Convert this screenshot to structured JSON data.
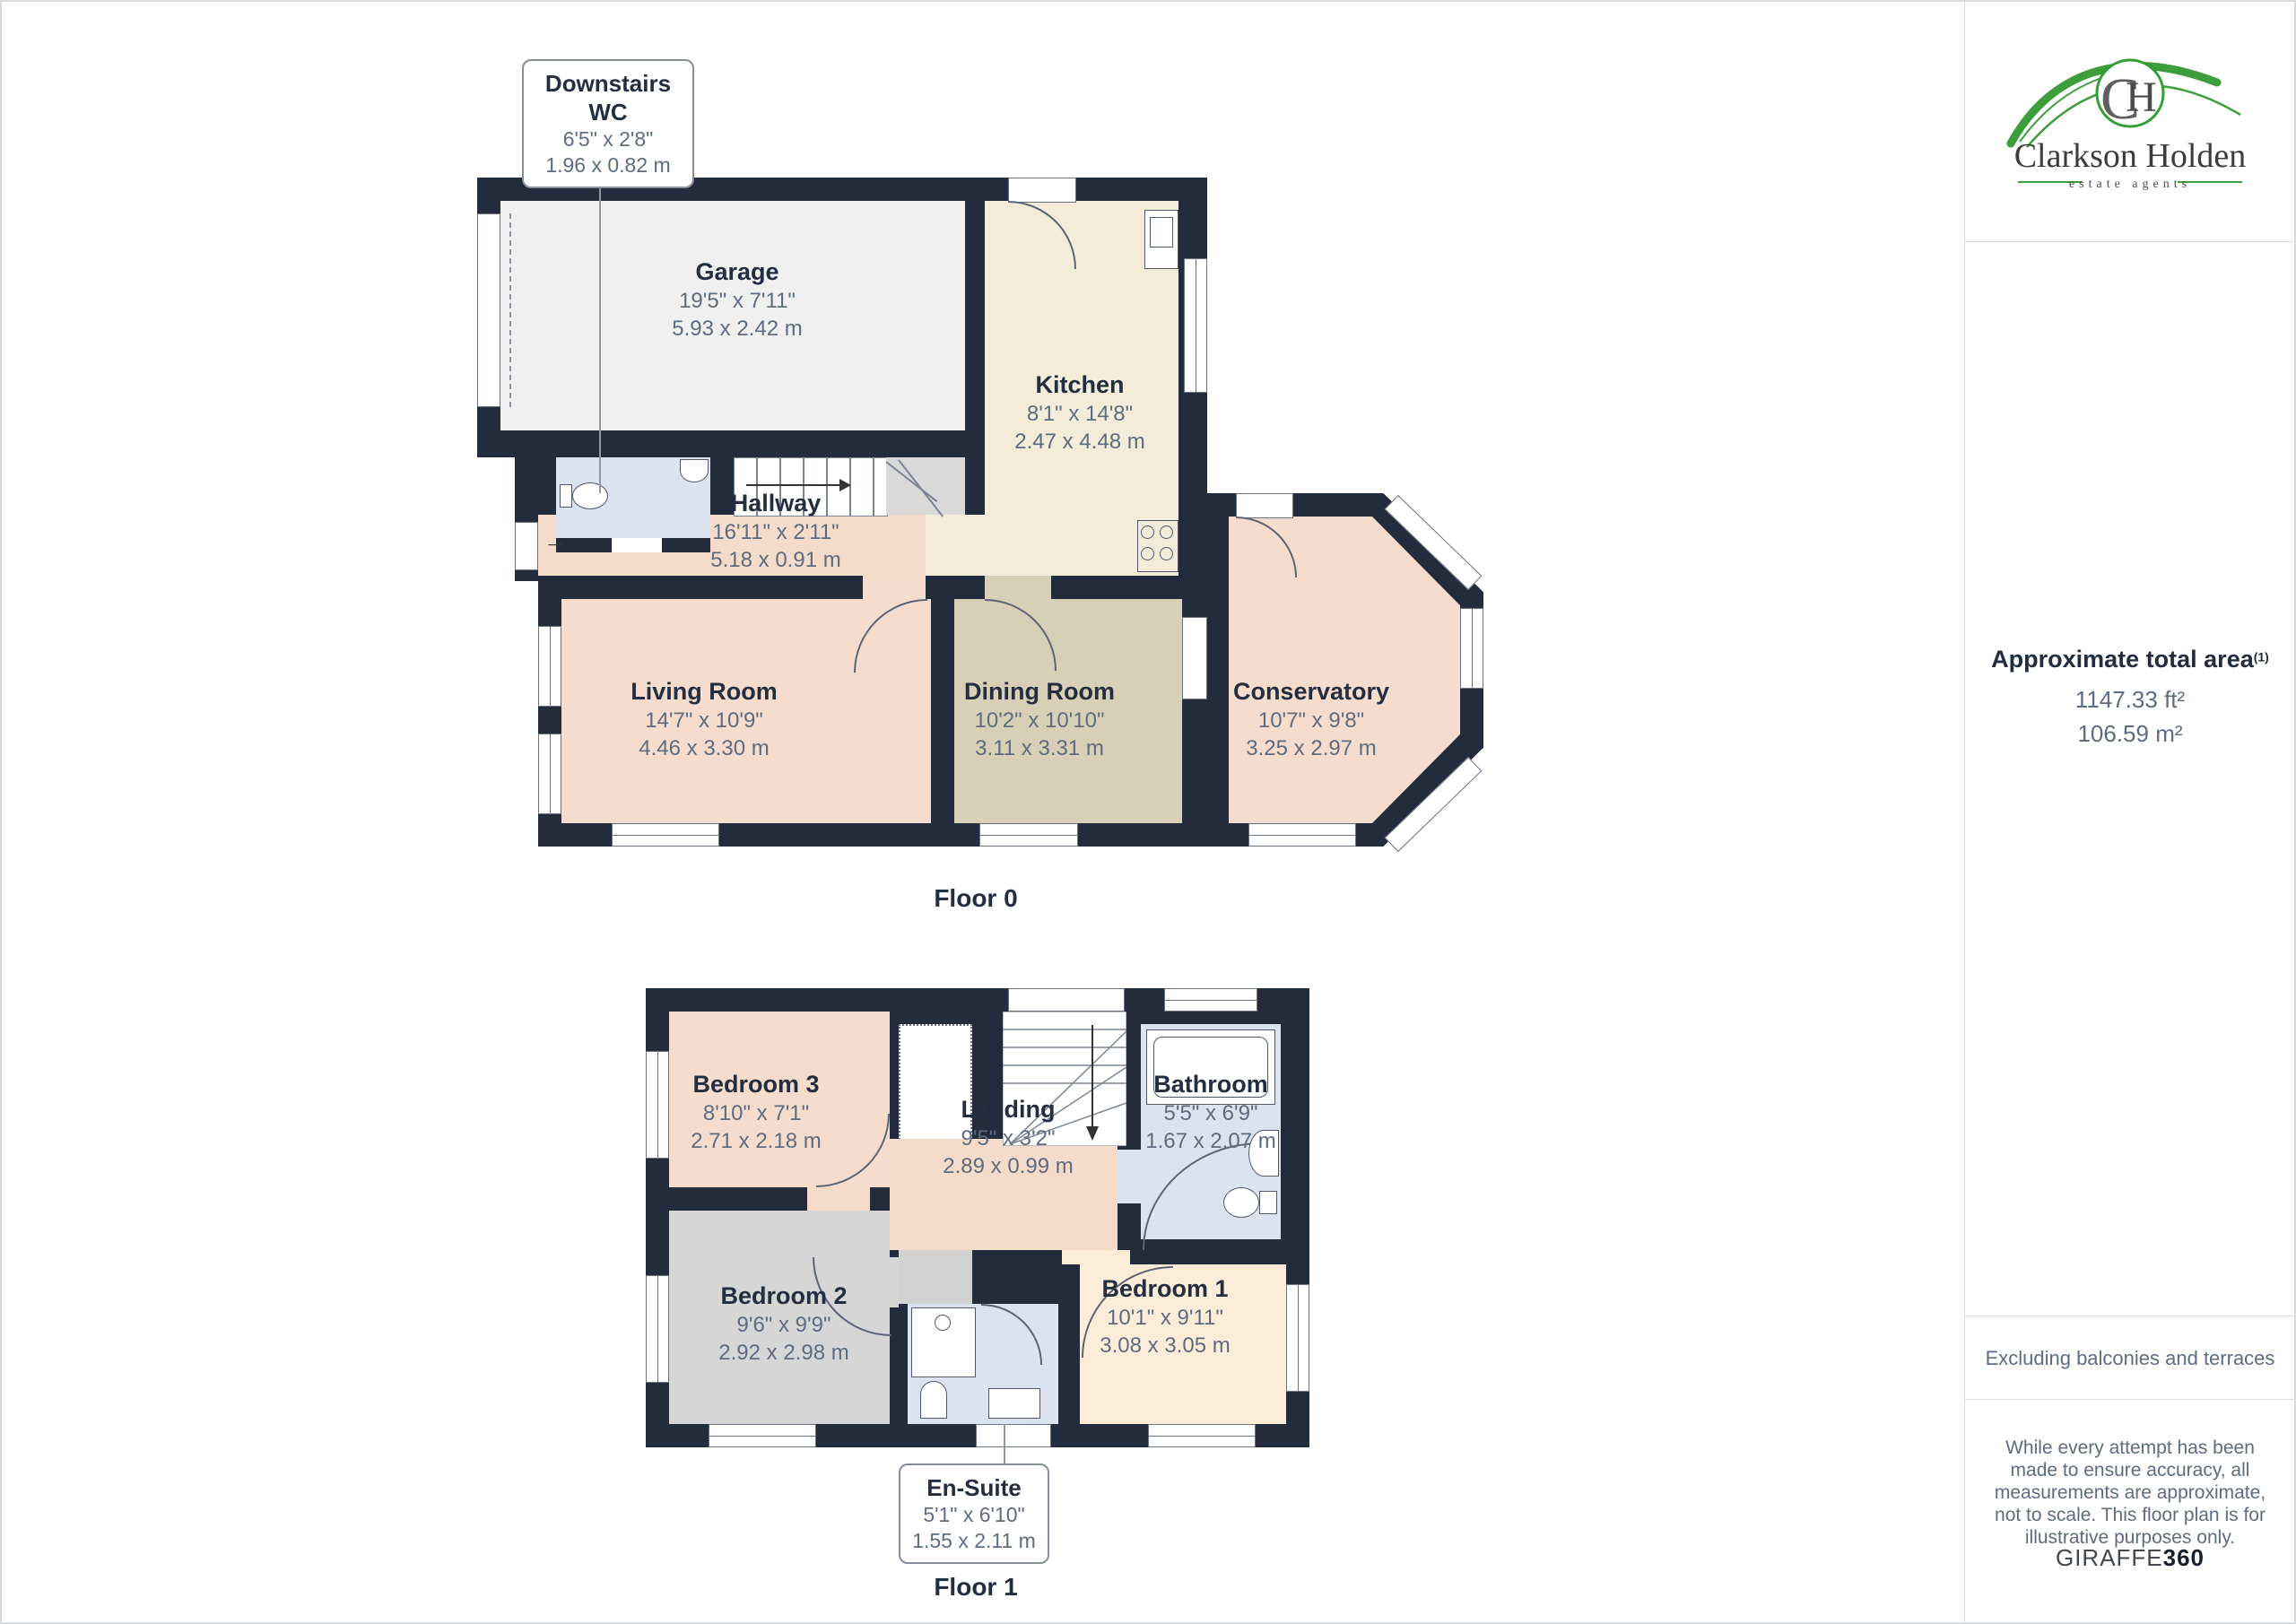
{
  "branding": {
    "name": "Clarkson Holden",
    "tagline": "estate agents",
    "monogram_c": "C",
    "monogram_h": "H"
  },
  "sidebar": {
    "area_title": "Approximate total area",
    "area_superscript": "(1)",
    "area_ft": "1147.33 ft²",
    "area_m": "106.59 m²",
    "excluding_note": "Excluding balconies and terraces",
    "disclaimer": "While every attempt has been made to ensure accuracy, all measurements are approximate, not to scale. This floor plan is for illustrative purposes only.",
    "brand": {
      "giraffe": "GIRAFFE",
      "suffix": "360"
    }
  },
  "floors": [
    {
      "label": "Floor 0",
      "rooms": [
        {
          "name": "Garage",
          "imperial": "19'5\" x 7'11\"",
          "metric": "5.93 x 2.42 m"
        },
        {
          "name": "Kitchen",
          "imperial": "8'1\" x 14'8\"",
          "metric": "2.47 x 4.48 m"
        },
        {
          "name": "Hallway",
          "imperial": "16'11\" x 2'11\"",
          "metric": "5.18 x 0.91 m"
        },
        {
          "name": "Living Room",
          "imperial": "14'7\" x 10'9\"",
          "metric": "4.46 x 3.30 m"
        },
        {
          "name": "Dining Room",
          "imperial": "10'2\" x 10'10\"",
          "metric": "3.11 x 3.31 m"
        },
        {
          "name": "Conservatory",
          "imperial": "10'7\" x 9'8\"",
          "metric": "3.25 x 2.97 m"
        }
      ]
    },
    {
      "label": "Floor 1",
      "rooms": [
        {
          "name": "Bedroom 3",
          "imperial": "8'10\" x 7'1\"",
          "metric": "2.71 x 2.18 m"
        },
        {
          "name": "Landing",
          "imperial": "9'5\" x 3'2\"",
          "metric": "2.89 x 0.99 m"
        },
        {
          "name": "Bathroom",
          "imperial": "5'5\" x 6'9\"",
          "metric": "1.67 x 2.07 m"
        },
        {
          "name": "Bedroom 2",
          "imperial": "9'6\" x 9'9\"",
          "metric": "2.92 x 2.98 m"
        },
        {
          "name": "Bedroom 1",
          "imperial": "10'1\" x 9'11\"",
          "metric": "3.08 x 3.05 m"
        }
      ]
    }
  ],
  "callouts": [
    {
      "title": "Downstairs WC",
      "imperial": "6'5\" x 2'8\"",
      "metric": "1.96 x 0.82 m"
    },
    {
      "title": "En-Suite",
      "imperial": "5'1\" x 6'10\"",
      "metric": "1.55 x 2.11 m"
    }
  ],
  "colors": {
    "wall": "#222c3d",
    "garage": "#f0f0f1",
    "kitchen": "#f2ecd8",
    "hallway": "#f4dbca",
    "living": "#f5dccd",
    "dining": "#d8d0b6",
    "bathroom": "#dce3f0",
    "bedroom2": "#d6d6d7",
    "bedroom1": "#fdecd8",
    "stairs": "#d9d9d9",
    "brand_green": "#3d9e3b",
    "title_text": "#232e41",
    "dim_text": "#5d6c80"
  }
}
